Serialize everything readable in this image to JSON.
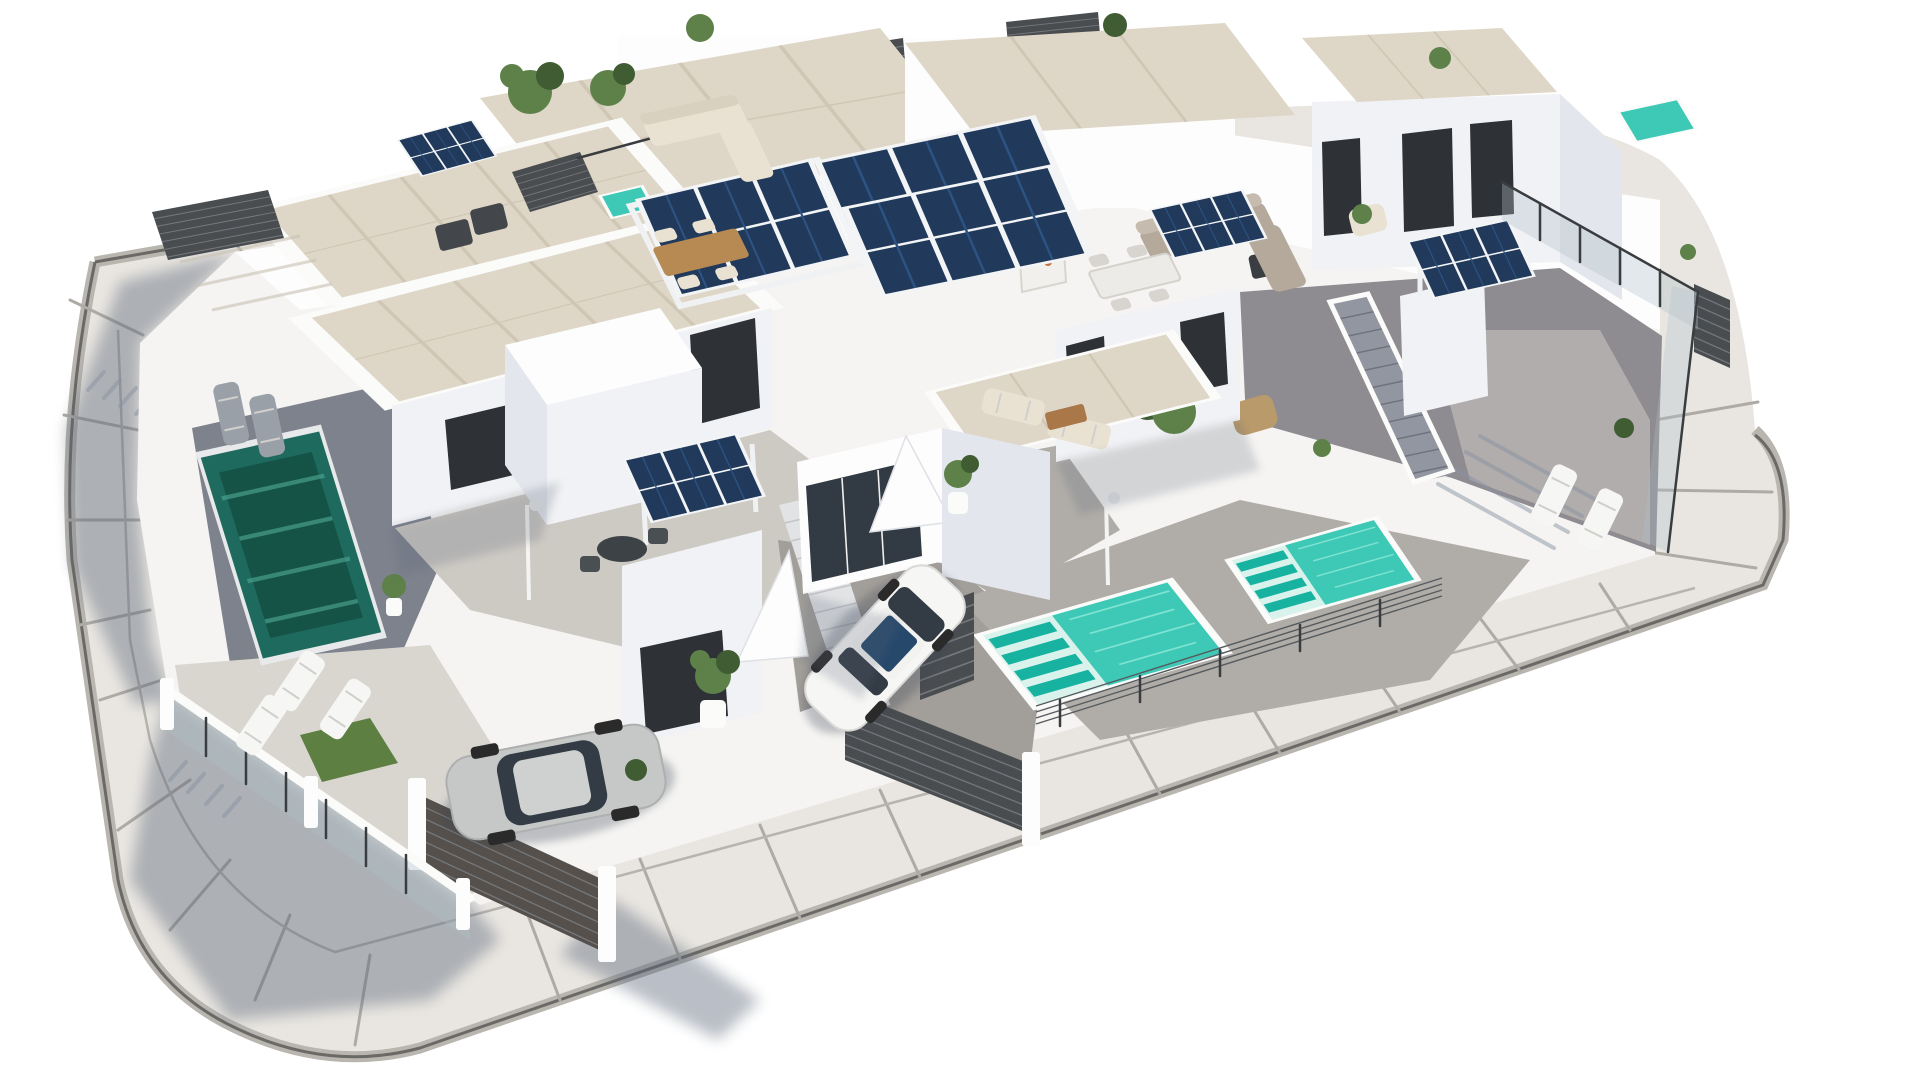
{
  "scene": {
    "type": "3d-architectural-aerial-render",
    "subject": "Aerial 3D render of a modern white villa residential block with rooftop terraces, pergola-mounted solar panels, plunge pools, patios with outdoor furniture, two parked cars and a curved perimeter road",
    "style": "photoreal CGI, white background, sun from upper right casting blue-grey shadows to lower left"
  },
  "inventory": {
    "villas_visible": 6,
    "solar_panel_arrays": 8,
    "pools": {
      "count": 5,
      "types": [
        "dark teal ground pool",
        "turquoise lounger pool",
        "turquoise lounger pool",
        "rooftop plunge pool",
        "rooftop plunge pool"
      ]
    },
    "cars": [
      {
        "name": "white-hatchback",
        "location": "centre driveway"
      },
      {
        "name": "silver-suv",
        "location": "lower-left driveway"
      }
    ],
    "outdoor_furniture": [
      "corner sofas",
      "dining tables with chairs",
      "sun loungers",
      "round bistro table",
      "outdoor kitchen shelves",
      "bbq"
    ],
    "landscape": [
      "potted plants",
      "small trees",
      "grass patch",
      "slatted privacy fences",
      "glass balustrades",
      "cable railings",
      "entry gates",
      "external staircases",
      "outdoor showers"
    ]
  },
  "palette": {
    "background": "#ffffff",
    "road": "#e9e6e1",
    "road_curb_band": "#b9b6b0",
    "road_curb_edge": "#6b6966",
    "road_joint": "#aeaba5",
    "road_shadow": "#5c6678",
    "plot": "#f5f4f2",
    "wall_white": "#fdfdfd",
    "wall_front": "#f1f2f5",
    "wall_side": "#e3e6ec",
    "wall_shade": "#cfd4dd",
    "deck_shade": "#7d828d",
    "roof_beige": "#ded6c7",
    "roof_line": "#cfc6b4",
    "paving": "#b0ada8",
    "paving_shade": "#8e8c90",
    "paving_light": "#cdc9c3",
    "driveway": "#a29e99",
    "garden_light": "#d9d6d0",
    "solar_navy": "#21395a",
    "solar_cell": "#2d5382",
    "solar_frame": "#f2f4f6",
    "pool_deep": "#1e6a5e",
    "pool_deep_dark": "#155347",
    "pool_bright": "#3ec9b7",
    "pool_shelf": "#d9f3ec",
    "pool_lounger": "#18b2a1",
    "fence_dark": "#4a4d50",
    "gate_dark": "#55504b",
    "railing_dark": "#3a3d40",
    "glass_tint": "#aebfc9",
    "grass": "#5e7f42",
    "plant": "#5d8148",
    "plant_dark": "#3f5c33",
    "cream": "#e9e2d2",
    "taupe": "#b4a99b",
    "wood": "#b68a52",
    "accent_orange": "#c4703d",
    "accent_red": "#b43b2e",
    "car_white": "#f6f6f4",
    "car_silver": "#c6c8c7",
    "car_glass": "#333b45",
    "stair_dark": "#9296a0",
    "shadow_soft": "#5c6678"
  }
}
